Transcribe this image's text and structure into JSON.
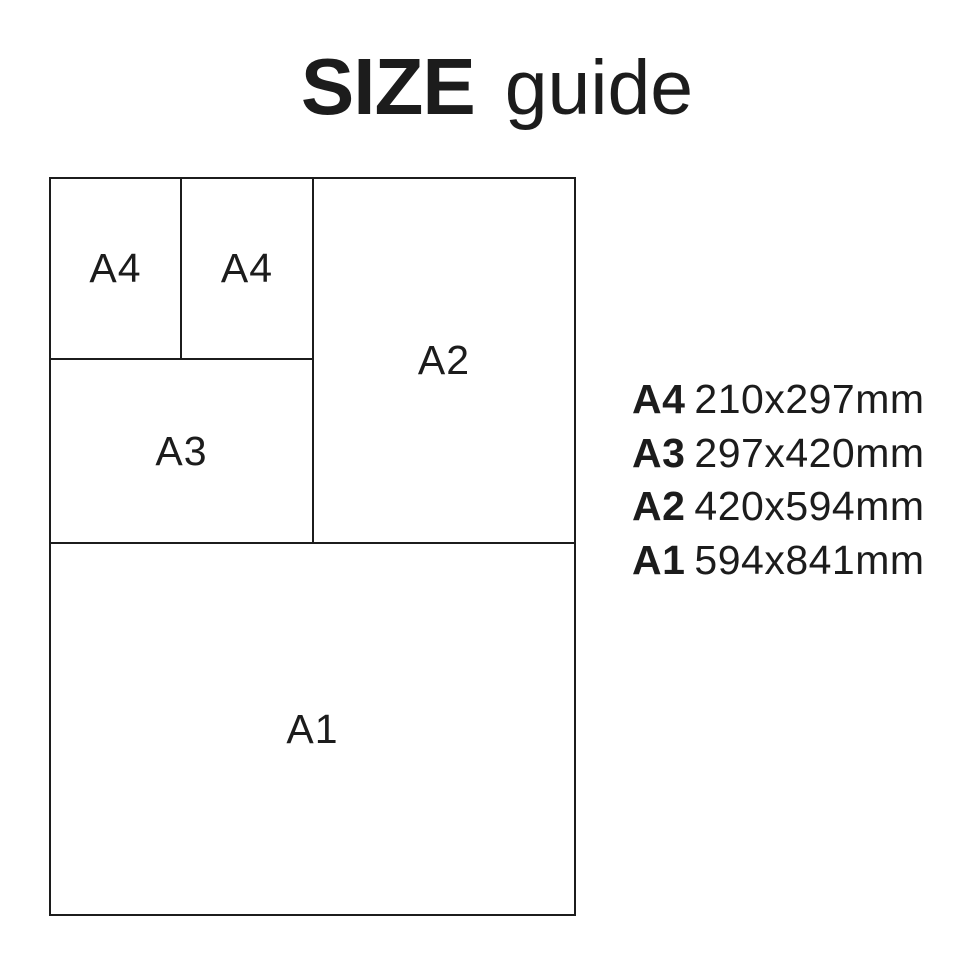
{
  "title": {
    "primary": "SIZE",
    "secondary": "guide"
  },
  "diagram": {
    "boxes": [
      {
        "id": "a4-left",
        "label": "A4"
      },
      {
        "id": "a4-right",
        "label": "A4"
      },
      {
        "id": "a3",
        "label": "A3"
      },
      {
        "id": "a2",
        "label": "A2"
      },
      {
        "id": "a1",
        "label": "A1"
      }
    ]
  },
  "legend": {
    "items": [
      {
        "size": "A4",
        "dimensions": "210x297mm"
      },
      {
        "size": "A3",
        "dimensions": "297x420mm"
      },
      {
        "size": "A2",
        "dimensions": "420x594mm"
      },
      {
        "size": "A1",
        "dimensions": "594x841mm"
      }
    ]
  },
  "colors": {
    "ink": "#1c1c1c",
    "background": "#ffffff"
  }
}
